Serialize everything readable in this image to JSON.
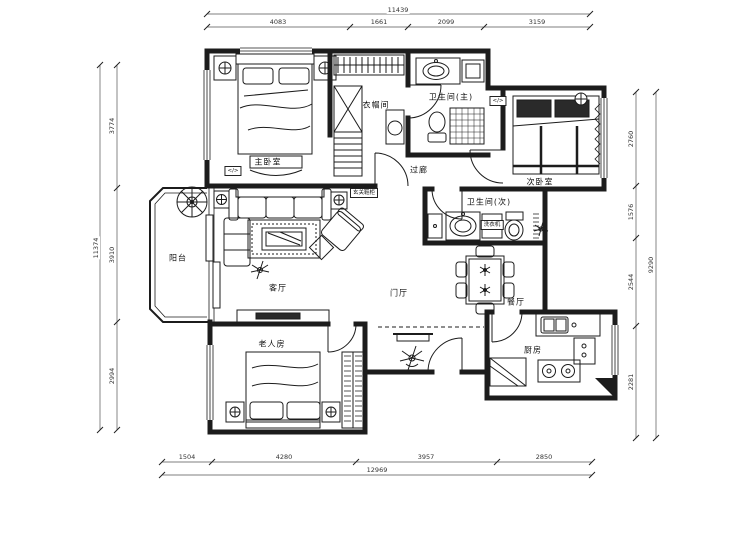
{
  "document": {
    "type": "apartment-floor-plan"
  },
  "rooms": {
    "master_bedroom": "主卧室",
    "cloakroom": "衣帽间",
    "bathroom_master": "卫生间(主)",
    "corridor": "过廊",
    "second_bedroom": "次卧室",
    "bathroom_second": "卫生间(次)",
    "balcony": "阳台",
    "living_room": "客厅",
    "entrance_hall": "门厅",
    "dining_room": "餐厅",
    "elder_room": "老人房",
    "kitchen": "厨房"
  },
  "tags": {
    "entry_cabinet": "玄关鞋柜",
    "washing_machine": "洗衣机",
    "ac_master": "</>",
    "ac_second": "</>"
  },
  "dimensions": {
    "top": {
      "total": "11439",
      "segments": [
        "4083",
        "1661",
        "2099",
        "3159"
      ]
    },
    "bottom": {
      "total": "12969",
      "segments": [
        "1504",
        "4280",
        "3957",
        "2850"
      ]
    },
    "left": {
      "total": "11374",
      "segments": [
        "3774",
        "3910",
        "2994"
      ]
    },
    "right": {
      "total": "9290",
      "segments": [
        "2760",
        "1576",
        "2544",
        "2281"
      ]
    }
  },
  "colors": {
    "line": "#1c1c1c",
    "dim_line": "#555555",
    "background": "#ffffff"
  }
}
